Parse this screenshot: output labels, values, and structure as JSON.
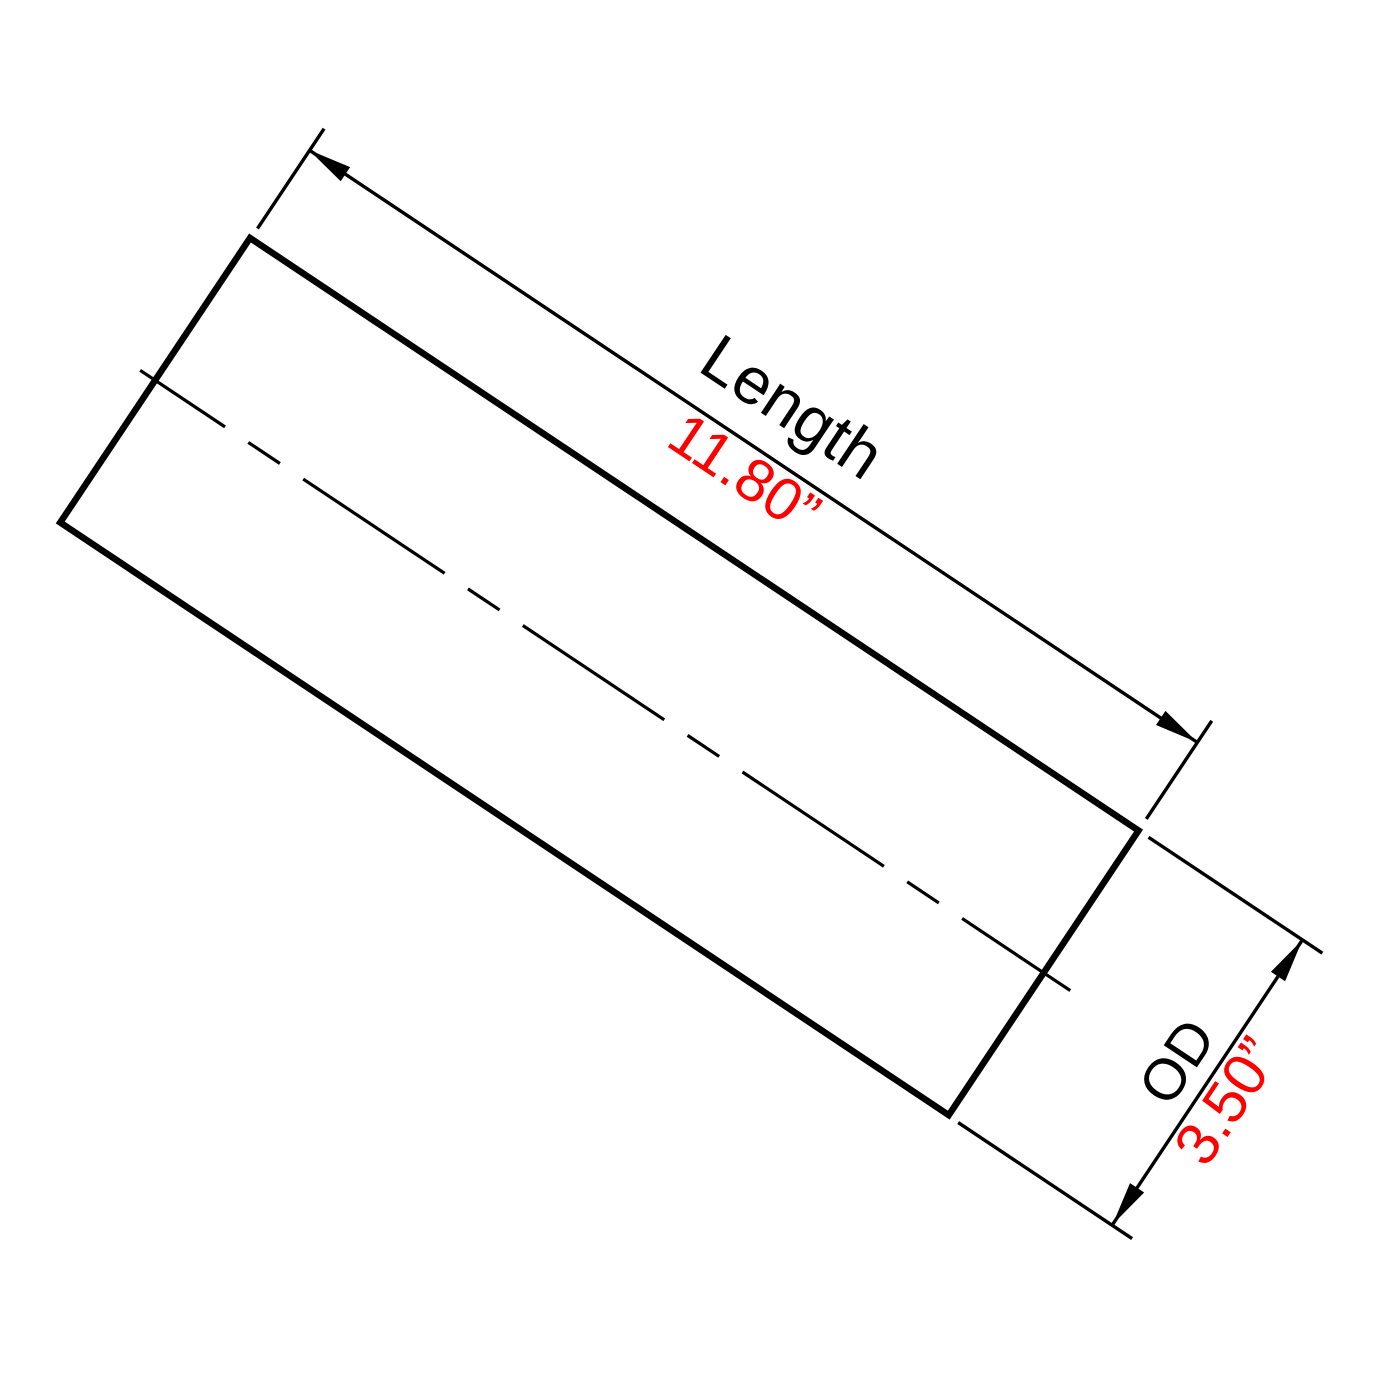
{
  "diagram": {
    "type": "technical-dimension-drawing",
    "part": "tube-side-view",
    "length_dimension": {
      "label": "Length",
      "value": "11.80”"
    },
    "od_dimension": {
      "label": "OD",
      "value": "3.50”"
    }
  },
  "colors": {
    "line_black": "#000000",
    "label_black": "#000000",
    "value_red": "#fe0000",
    "background": "#ffffff"
  }
}
